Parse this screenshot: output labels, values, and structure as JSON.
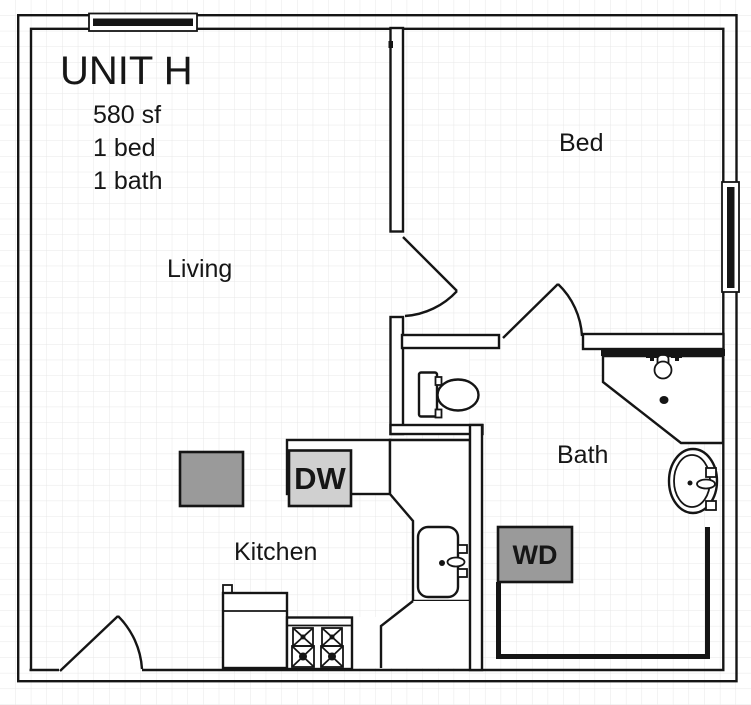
{
  "floorplan": {
    "unit": {
      "title": "UNIT H",
      "area": "580 sf",
      "beds": "1 bed",
      "baths": "1 bath"
    },
    "rooms": {
      "living": "Living",
      "bed": "Bed",
      "bath": "Bath",
      "kitchen": "Kitchen"
    },
    "appliances": {
      "dishwasher": "DW",
      "washer_dryer": "WD"
    }
  },
  "colors": {
    "wall": "#151515",
    "grid_line": "#e7e7e7",
    "background": "#ffffff",
    "gray_dark": "#9a9a9a",
    "gray_light": "#d0d0d0"
  }
}
